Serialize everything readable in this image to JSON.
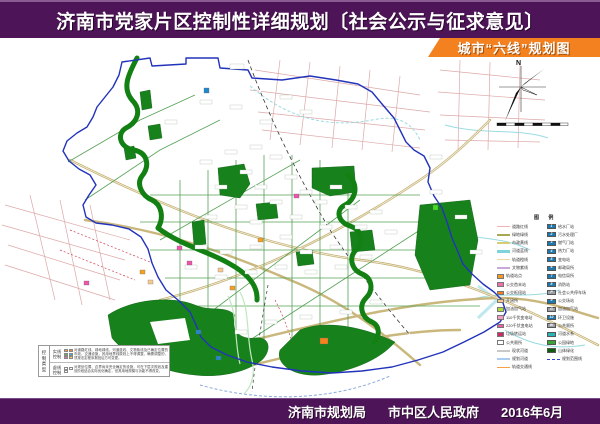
{
  "header": {
    "title": "济南市党家片区控制性详细规划〔社会公示与征求意见〕",
    "subtitle": "城市“六线”规划图"
  },
  "footer": {
    "agency1": "济南市规划局",
    "agency2": "市中区人民政府",
    "date": "2016年6月"
  },
  "compass": {
    "north_label": "N"
  },
  "colors": {
    "banner_purple": "#4e1458",
    "ribbon_orange": "#f48120",
    "boundary_blue": "#2233bb",
    "green_space": "#17821c",
    "river_green": "#128012",
    "road_tan": "#c9b77c",
    "road_pink": "#dda8a8",
    "stream_cyan": "#9adbe2"
  },
  "legend": {
    "title": "图  例",
    "left_items": [
      {
        "kind": "line",
        "color": "#f2b2b2",
        "label": "道路红线"
      },
      {
        "kind": "line",
        "color": "#a8a852",
        "label": "绿地绿线"
      },
      {
        "kind": "line",
        "color": "#d8cc7a",
        "label": "市政黄线"
      },
      {
        "kind": "line",
        "color": "#7fd4dc",
        "label": "河道蓝线",
        "thick": true
      },
      {
        "kind": "line",
        "color": "#ecd9a0",
        "label": "轨道橙线"
      },
      {
        "kind": "line",
        "color": "#c8a8d8",
        "label": "文物紫线"
      },
      {
        "kind": "box",
        "color": "#f59a23",
        "label": "轨道站点"
      },
      {
        "kind": "box",
        "color": "#f06eaa",
        "label": "公交首末站"
      },
      {
        "kind": "box",
        "color": "#f57e20",
        "label": "公交枢纽站"
      },
      {
        "kind": "box",
        "color": "#f8c98e",
        "label": "开闭所"
      },
      {
        "kind": "box",
        "color": "#aade38",
        "label": "加油加气站"
      },
      {
        "kind": "box",
        "color": "#f79ac8",
        "label": "110千伏变电站"
      },
      {
        "kind": "box",
        "color": "#ee5fa0",
        "label": "220千伏变电站"
      },
      {
        "kind": "box",
        "color": "#cc2a66",
        "label": "垃圾转运站"
      },
      {
        "kind": "box",
        "color": "#ffffff",
        "label": "公共厕所"
      },
      {
        "kind": "line",
        "color": "#c8c8c8",
        "label": "现状河道"
      },
      {
        "kind": "line",
        "color": "#aaccee",
        "label": "规划河道"
      },
      {
        "kind": "line",
        "color": "#f5a34a",
        "label": "轨道交通线"
      }
    ],
    "right_items": [
      {
        "kind": "sq",
        "color": "#1a7ab0",
        "mark": "1",
        "label": "给水厂站"
      },
      {
        "kind": "sq",
        "color": "#1a7ab0",
        "mark": "2",
        "label": "污水处理厂"
      },
      {
        "kind": "sq",
        "color": "#1a7ab0",
        "mark": "3",
        "label": "燃气门站"
      },
      {
        "kind": "sq",
        "color": "#1a7ab0",
        "mark": "4",
        "label": "热力厂站"
      },
      {
        "kind": "sq",
        "color": "#1a7ab0",
        "mark": "5",
        "label": "变电站"
      },
      {
        "kind": "sq",
        "color": "#1a7ab0",
        "mark": "6",
        "label": "邮政局所"
      },
      {
        "kind": "sq",
        "color": "#1a7ab0",
        "mark": "7",
        "label": "电信局所"
      },
      {
        "kind": "sq",
        "color": "#1a7ab0",
        "mark": "8",
        "label": "消防站"
      },
      {
        "kind": "sq",
        "color": "#9aa0a6",
        "mark": "P",
        "label": "社会公共停车场"
      },
      {
        "kind": "sq",
        "color": "#1a7ab0",
        "mark": "9",
        "label": "公交场站"
      },
      {
        "kind": "sq",
        "color": "#9aa0a6",
        "mark": "G",
        "label": "加油加气站"
      },
      {
        "kind": "sq",
        "color": "#1a7ab0",
        "mark": "10",
        "label": "环卫设施"
      },
      {
        "kind": "sq",
        "color": "#9aa0a6",
        "mark": "W",
        "label": "公共厕所"
      },
      {
        "kind": "sq",
        "color": "#2ab5b5",
        "mark": "",
        "label": "河道水系"
      },
      {
        "kind": "sq",
        "color": "#37a437",
        "mark": "",
        "label": "公园绿地"
      },
      {
        "kind": "sq",
        "color": "#0c5e0c",
        "mark": "",
        "label": "山体绿化"
      },
      {
        "kind": "dash",
        "color": "#3344cc",
        "label": "规划范围线"
      }
    ]
  },
  "notes": {
    "header": "控制类型",
    "rows": [
      {
        "label": "实线控制",
        "swatches": [
          "#f49c3a",
          "#f57e20",
          "#6ab04c",
          "#35b8b8",
          "#f06eaa",
          "#f5e043"
        ],
        "text": "对道路红线、绿地绿线、河道蓝线、文物紫线及已确定位置的市政、交通设施，其用地界线原则上不得调整，确需调整的，须按法定程序报批后方可变更。"
      },
      {
        "label": "虚线控制",
        "swatches": [
          "#ffffff",
          "#ffffff",
          "#ffffff"
        ],
        "text": "对规划位置、边界尚未完全确定的设施，可在下层次规划及建设阶段结合实际优化确定，但其用地规模与功能不得改变。"
      }
    ]
  }
}
